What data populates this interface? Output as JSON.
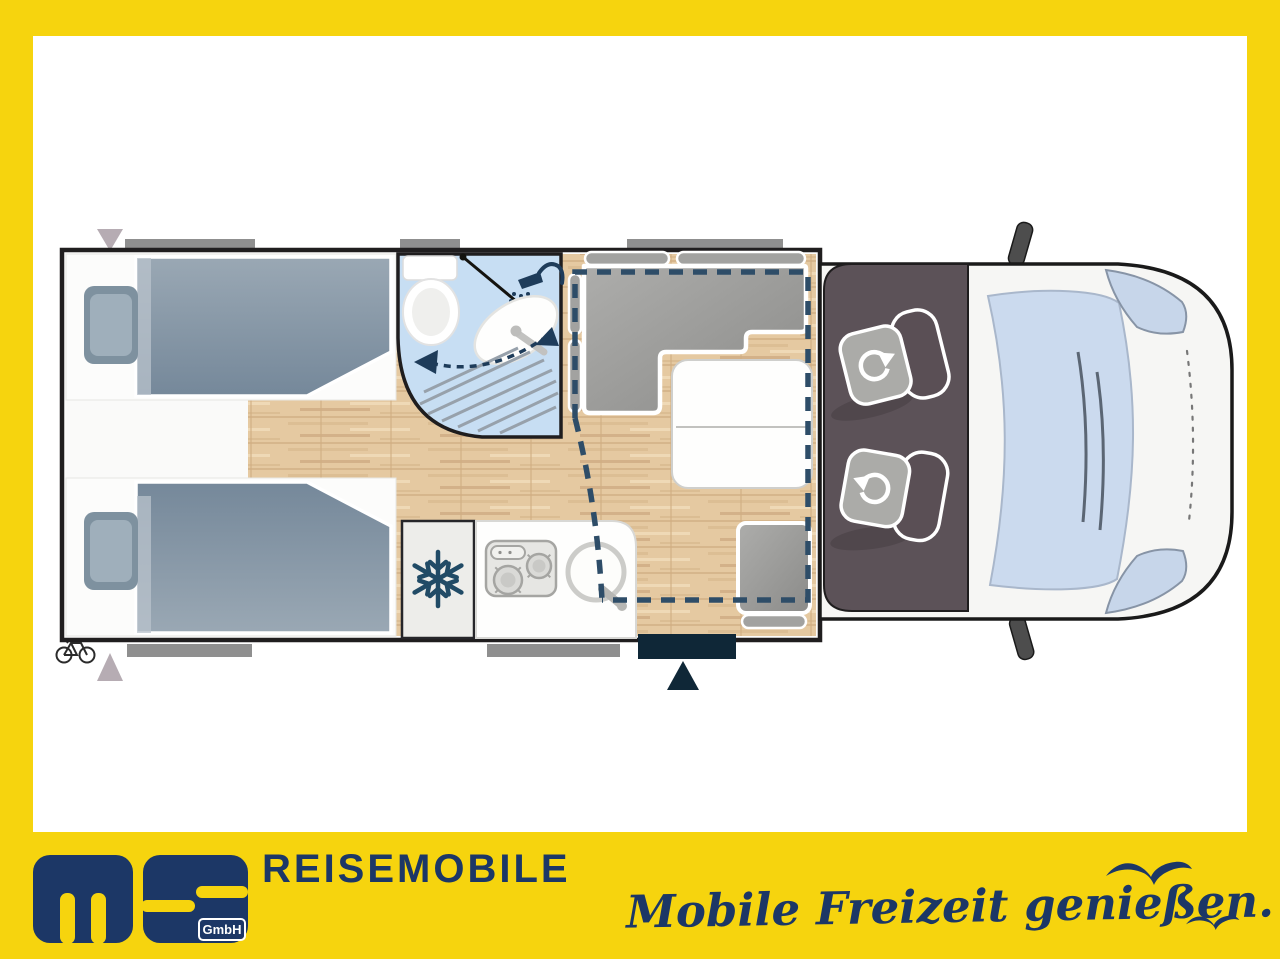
{
  "brand": {
    "name": "MS",
    "suffix": "GmbH",
    "wordmark": "REISEMOBILE",
    "slogan": "Mobile Freizeit genießen."
  },
  "colors": {
    "frame_yellow": "#F6D40E",
    "brand_navy": "#1C3766",
    "plan_dash_blue": "#2E4D68",
    "wall_black": "#1F1D1E",
    "wood_floor": "#E5C9A1",
    "bathroom_blue": "#C7DEF3",
    "cab_taupe": "#5C5258",
    "duvet_gray_blue": "#7A8A99",
    "window_gray": "#8F8F8F",
    "entry_door_navy": "#0F2737"
  },
  "floorplan": {
    "icons": [
      "bicycle-icon",
      "snowflake-icon",
      "shower-head-icon",
      "rotate-arrow-icon",
      "entry-arrow-icon",
      "triangle-marker-icon",
      "seagull-icon"
    ]
  }
}
